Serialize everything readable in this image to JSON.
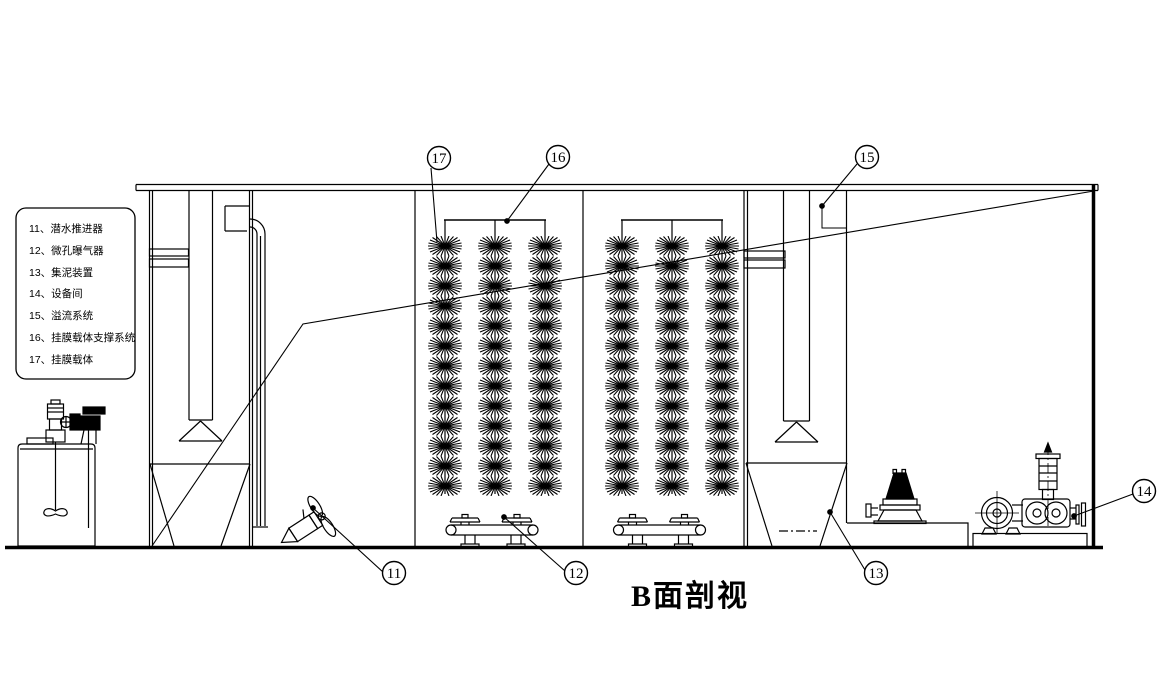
{
  "drawing": {
    "title": "B面剖视",
    "background_color": "#ffffff",
    "line_color": "#000000"
  },
  "legend": {
    "items": [
      "11、潜水推进器",
      "12、微孔曝气器",
      "13、集泥装置",
      "14、设备间",
      "15、溢流系统",
      "16、挂膜载体支撑系统",
      "17、挂膜载体"
    ]
  },
  "callouts": {
    "c11": "11",
    "c12": "12",
    "c13": "13",
    "c14": "14",
    "c15": "15",
    "c16": "16",
    "c17": "17"
  }
}
